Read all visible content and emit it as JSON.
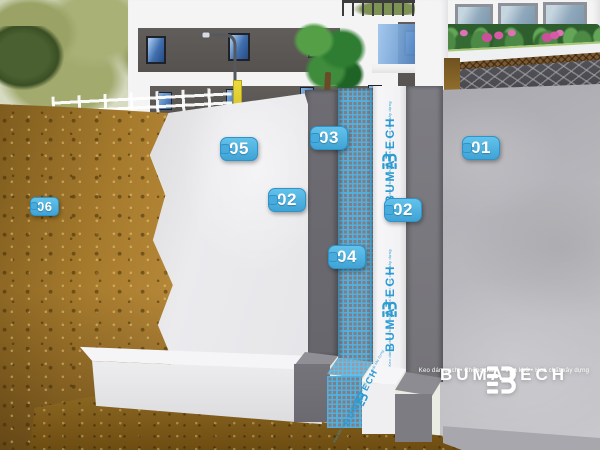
{
  "callouts": [
    {
      "number": "01"
    },
    {
      "number": "02"
    },
    {
      "number": "02"
    },
    {
      "number": "03"
    },
    {
      "number": "04"
    },
    {
      "number": "05"
    },
    {
      "number": "06"
    }
  ],
  "membrane_print": {
    "brand": "BUMATECH",
    "tagline": "Keo dán gạch • Chống thấm • Vữa khô • Hoá chất xây dựng"
  },
  "footer_brand": {
    "name": "BUMATECH",
    "tagline": "Keo dán gạch • Chống thấm • Vữa khô • Hoá chất xây dựng"
  },
  "colors": {
    "callout_blue": "#49ABDC",
    "membrane_print_blue": "#2E9BD2",
    "mesh_blue": "#4FAEDF",
    "soil_brown": "#A87C2E",
    "concrete_gray": "#B9B8BD",
    "mortar_gray": "#6E6D73",
    "wall_white": "#E9E9EC",
    "logo_white": "#FFFFFF"
  }
}
